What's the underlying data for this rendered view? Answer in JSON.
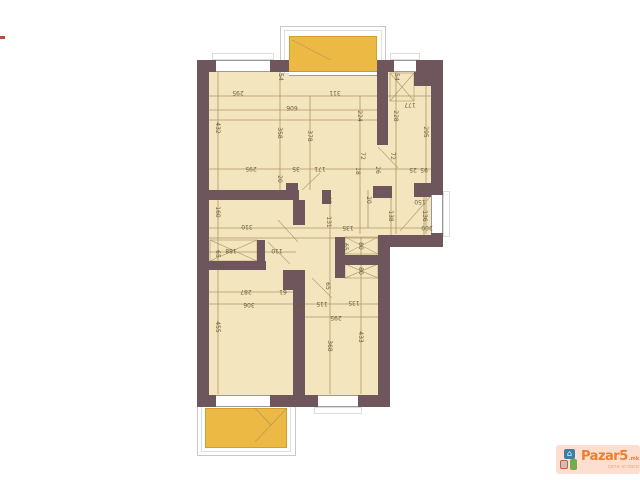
{
  "watermark": {
    "brand": "Pazar5",
    "tld": ".mk",
    "tagline": "сите огласи",
    "house_icon": "⌂"
  },
  "plan": {
    "colors": {
      "wall": "#6e565c",
      "floor": "#f3e5bd",
      "line": "#a98e5f",
      "label": "#6b5a3e",
      "balcony": "#ecb944",
      "balcony_edge": "#cfa02e",
      "rail_outer": "#c8c8c8",
      "rail_mid": "#dedede",
      "window_line": "#9a9a9a",
      "sill": "#dddddd",
      "artifact_red": "#b94a48"
    },
    "floors": [
      [
        209,
        72,
        222,
        163
      ],
      [
        209,
        190,
        170,
        205
      ]
    ],
    "walls": [
      [
        197,
        60,
        12,
        347
      ],
      [
        197,
        60,
        246,
        12
      ],
      [
        431,
        60,
        12,
        187
      ],
      [
        378,
        235,
        65,
        12
      ],
      [
        378,
        235,
        12,
        172
      ],
      [
        197,
        395,
        193,
        12
      ],
      [
        377,
        72,
        11,
        73
      ],
      [
        373,
        186,
        19,
        12
      ],
      [
        209,
        190,
        90,
        10
      ],
      [
        286,
        183,
        12,
        8
      ],
      [
        322,
        190,
        9,
        14
      ],
      [
        293,
        200,
        12,
        25
      ],
      [
        293,
        270,
        12,
        125
      ],
      [
        283,
        270,
        10,
        20
      ],
      [
        335,
        237,
        10,
        41
      ],
      [
        345,
        255,
        33,
        10
      ],
      [
        257,
        240,
        8,
        22
      ],
      [
        209,
        261,
        57,
        9
      ],
      [
        414,
        72,
        17,
        14
      ],
      [
        414,
        183,
        17,
        14
      ]
    ],
    "windows": [
      [
        216,
        60,
        54,
        12,
        "h"
      ],
      [
        394,
        60,
        22,
        12,
        "h"
      ],
      [
        431,
        195,
        12,
        38,
        "v"
      ],
      [
        318,
        395,
        40,
        12,
        "h"
      ],
      [
        216,
        395,
        54,
        12,
        "h"
      ]
    ],
    "sills": [
      [
        212,
        53,
        62,
        7
      ],
      [
        390,
        53,
        30,
        7
      ],
      [
        443,
        191,
        7,
        46
      ],
      [
        314,
        407,
        48,
        7
      ]
    ],
    "hlines": [
      [
        96,
        209,
        431
      ],
      [
        110,
        209,
        377
      ],
      [
        120,
        209,
        377
      ],
      [
        169,
        209,
        443
      ],
      [
        228,
        209,
        443
      ],
      [
        238,
        209,
        390
      ],
      [
        252,
        209,
        296
      ],
      [
        292,
        209,
        305
      ],
      [
        304,
        209,
        390
      ],
      [
        317,
        305,
        378
      ]
    ],
    "vlines": [
      [
        218,
        72,
        394
      ],
      [
        280,
        72,
        190
      ],
      [
        310,
        96,
        190
      ],
      [
        330,
        200,
        394
      ],
      [
        360,
        96,
        234
      ],
      [
        361,
        237,
        394
      ],
      [
        396,
        72,
        234
      ],
      [
        426,
        72,
        234
      ],
      [
        368,
        190,
        228
      ],
      [
        391,
        195,
        235
      ],
      [
        424,
        183,
        235
      ]
    ],
    "diagonals": [
      [
        378,
        147,
        398,
        168
      ],
      [
        302,
        190,
        320,
        173
      ],
      [
        268,
        242,
        290,
        264
      ],
      [
        312,
        278,
        332,
        298
      ],
      [
        430,
        197,
        400,
        231
      ],
      [
        278,
        220,
        298,
        242
      ]
    ],
    "crosses": [
      [
        210,
        240,
        47,
        21
      ],
      [
        345,
        237,
        33,
        17
      ],
      [
        345,
        264,
        33,
        14
      ],
      [
        390,
        73,
        24,
        28
      ]
    ],
    "labels": [
      [
        "295",
        238,
        92,
        "h"
      ],
      [
        "311",
        335,
        92,
        "h"
      ],
      [
        "606",
        292,
        107,
        "h"
      ],
      [
        "54",
        280,
        77,
        "v"
      ],
      [
        "54",
        396,
        77,
        "v"
      ],
      [
        "38",
        424,
        80,
        "v"
      ],
      [
        "432",
        217,
        128,
        "v"
      ],
      [
        "358",
        279,
        133,
        "v"
      ],
      [
        "378",
        309,
        136,
        "v"
      ],
      [
        "224",
        359,
        116,
        "v"
      ],
      [
        "228",
        395,
        116,
        "v"
      ],
      [
        "177",
        410,
        104,
        "h"
      ],
      [
        "295",
        425,
        132,
        "v"
      ],
      [
        "295",
        251,
        168,
        "h"
      ],
      [
        "20",
        279,
        179,
        "v"
      ],
      [
        "35",
        296,
        168,
        "h"
      ],
      [
        "171",
        320,
        168,
        "h"
      ],
      [
        "18",
        357,
        171,
        "v"
      ],
      [
        "26",
        377,
        170,
        "v"
      ],
      [
        "72",
        362,
        156,
        "v"
      ],
      [
        "72",
        392,
        156,
        "v"
      ],
      [
        "25",
        413,
        169,
        "h"
      ],
      [
        "95",
        424,
        169,
        "h"
      ],
      [
        "38",
        422,
        188,
        "v"
      ],
      [
        "150",
        420,
        201,
        "h"
      ],
      [
        "20",
        368,
        200,
        "v"
      ],
      [
        "138",
        390,
        216,
        "v"
      ],
      [
        "136",
        424,
        216,
        "v"
      ],
      [
        "200",
        427,
        227,
        "h"
      ],
      [
        "160",
        217,
        212,
        "v"
      ],
      [
        "310",
        247,
        226,
        "h"
      ],
      [
        "48",
        328,
        200,
        "v"
      ],
      [
        "131",
        328,
        222,
        "v"
      ],
      [
        "135",
        348,
        227,
        "h"
      ],
      [
        "65",
        217,
        254,
        "v"
      ],
      [
        "188",
        231,
        250,
        "h"
      ],
      [
        "110",
        277,
        250,
        "h"
      ],
      [
        "98",
        221,
        266,
        "v"
      ],
      [
        "65",
        345,
        247,
        "v"
      ],
      [
        "80",
        360,
        246,
        "v"
      ],
      [
        "80",
        360,
        271,
        "v"
      ],
      [
        "287",
        246,
        291,
        "h"
      ],
      [
        "61",
        283,
        291,
        "h"
      ],
      [
        "306",
        249,
        304,
        "h"
      ],
      [
        "35",
        300,
        303,
        "h"
      ],
      [
        "115",
        322,
        303,
        "h"
      ],
      [
        "135",
        354,
        302,
        "h"
      ],
      [
        "295",
        336,
        317,
        "h"
      ],
      [
        "455",
        217,
        327,
        "v"
      ],
      [
        "368",
        329,
        346,
        "v"
      ],
      [
        "433",
        360,
        337,
        "v"
      ],
      [
        "65",
        327,
        286,
        "v"
      ]
    ],
    "balconies": {
      "top": {
        "rail_outer": [
          280,
          26,
          106,
          48
        ],
        "rail_mid": [
          284,
          30,
          98,
          44
        ],
        "slab": [
          289,
          36,
          88,
          38
        ],
        "through": [
          289,
          60,
          88,
          12
        ],
        "door": [
          289,
          71,
          88,
          5
        ],
        "diags": [
          [
            292,
            40,
            350,
            70
          ]
        ]
      },
      "bottom": {
        "rail_outer": [
          197,
          400,
          99,
          56
        ],
        "rail_mid": [
          201,
          404,
          90,
          48
        ],
        "slab": [
          205,
          408,
          82,
          40
        ],
        "diags": [
          [
            287,
            408,
            255,
            442
          ],
          [
            255,
            408,
            271,
            425
          ]
        ]
      }
    },
    "artifact": [
      0,
      36,
      5,
      3
    ]
  }
}
